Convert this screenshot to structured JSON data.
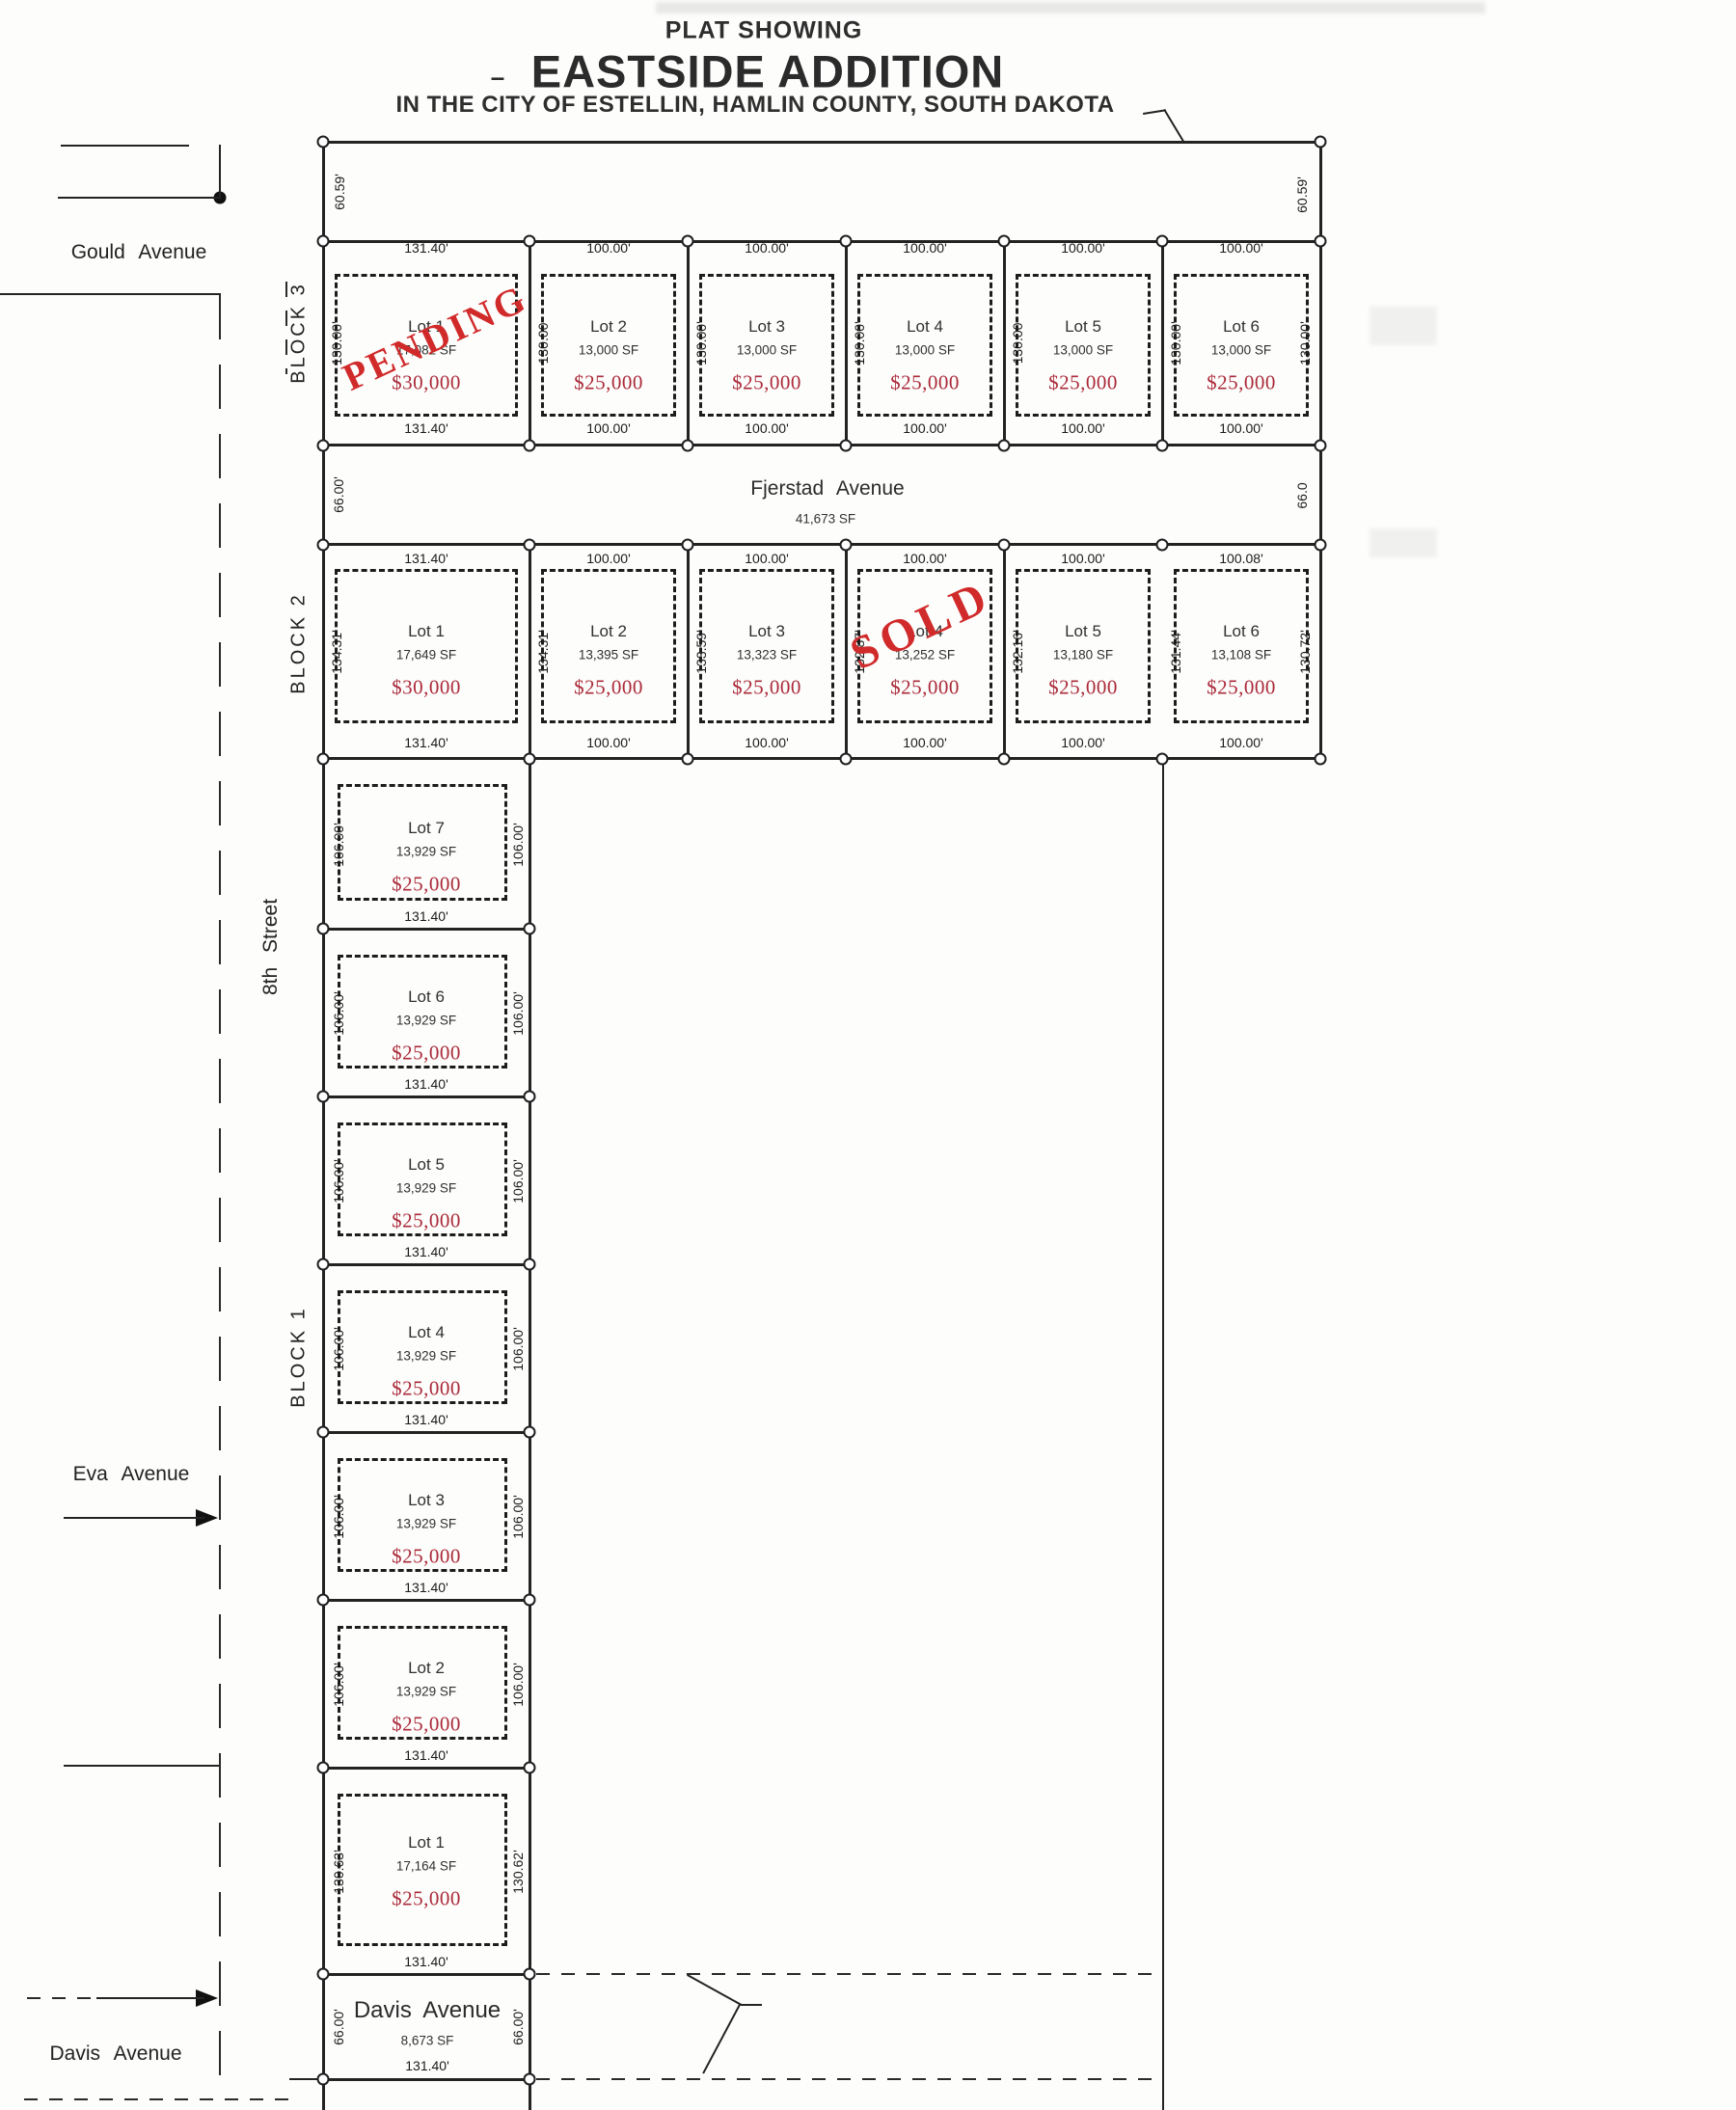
{
  "title": {
    "kicker": "PLAT SHOWING",
    "dash": "–",
    "name": "EASTSIDE ADDITION",
    "subtitle": "IN THE CITY OF ESTELLIN, HAMLIN COUNTY, SOUTH DAKOTA"
  },
  "streets": {
    "gould": "Gould Avenue",
    "eighth": "8th Street",
    "eva": "Eva Avenue",
    "davis": "Davis Avenue"
  },
  "avenue_fjerstad": {
    "name": "Fjerstad Avenue",
    "sf": "41,673 SF",
    "dim_left": "66.00'",
    "dim_right": "66.0"
  },
  "avenue_davis": {
    "name": "Davis Avenue",
    "sf": "8,673 SF",
    "dim_bottom": "131.40'",
    "dim_left": "66.00'",
    "dim_right": "66.00'"
  },
  "boundary_dims": {
    "northwest": "60.59'",
    "northeast": "60.59'"
  },
  "stamps": {
    "pending": "PENDING",
    "sold": "SOLD"
  },
  "colors": {
    "price_red": "#ab2b3a",
    "stamp_red": "#d12a2a",
    "line": "#232323"
  },
  "blocks": {
    "block3": {
      "label": "BLOCK 3",
      "lots": [
        {
          "name": "Lot 1",
          "sf": "17,082 SF",
          "price": "$30,000",
          "status": "PENDING",
          "dim_top": "131.40'",
          "dim_bottom": "131.40'",
          "dim_left": "130.00'"
        },
        {
          "name": "Lot 2",
          "sf": "13,000 SF",
          "price": "$25,000",
          "dim_top": "100.00'",
          "dim_bottom": "100.00'",
          "dim_left": "130.00"
        },
        {
          "name": "Lot 3",
          "sf": "13,000 SF",
          "price": "$25,000",
          "dim_top": "100.00'",
          "dim_bottom": "100.00'",
          "dim_left": "130.00'"
        },
        {
          "name": "Lot 4",
          "sf": "13,000 SF",
          "price": "$25,000",
          "dim_top": "100.00'",
          "dim_bottom": "100.00'",
          "dim_left": "130.00'"
        },
        {
          "name": "Lot 5",
          "sf": "13,000 SF",
          "price": "$25,000",
          "dim_top": "100.00'",
          "dim_bottom": "100.00'",
          "dim_left": "130.00"
        },
        {
          "name": "Lot 6",
          "sf": "13,000 SF",
          "price": "$25,000",
          "dim_top": "100.00'",
          "dim_bottom": "100.00'",
          "dim_left": "130.00'",
          "dim_right": "130.00'"
        }
      ]
    },
    "block2": {
      "label": "BLOCK 2",
      "lots": [
        {
          "name": "Lot 1",
          "sf": "17,649 SF",
          "price": "$30,000",
          "dim_top": "131.40'",
          "dim_bottom": "131.40'",
          "dim_left": "134.31'"
        },
        {
          "name": "Lot 2",
          "sf": "13,395 SF",
          "price": "$25,000",
          "dim_top": "100.00'",
          "dim_bottom": "100.00'",
          "dim_left": "134.31'"
        },
        {
          "name": "Lot 3",
          "sf": "13,323 SF",
          "price": "$25,000",
          "dim_top": "100.00'",
          "dim_bottom": "100.00'",
          "dim_left": "133.59'"
        },
        {
          "name": "Lot 4",
          "sf": "13,252 SF",
          "price": "$25,000",
          "status": "SOLD",
          "dim_top": "100.00'",
          "dim_bottom": "100.00'",
          "dim_left": "132.87'"
        },
        {
          "name": "Lot 5",
          "sf": "13,180 SF",
          "price": "$25,000",
          "dim_top": "100.00'",
          "dim_bottom": "100.00'",
          "dim_left": "132.16'"
        },
        {
          "name": "Lot 6",
          "sf": "13,108 SF",
          "price": "$25,000",
          "dim_top": "100.08'",
          "dim_bottom": "100.00'",
          "dim_left": "131.44'",
          "dim_right": "130.72'"
        }
      ]
    },
    "block1": {
      "label": "BLOCK 1",
      "lots": [
        {
          "name": "Lot 7",
          "sf": "13,929 SF",
          "price": "$25,000",
          "dim_bottom": "131.40'",
          "dim_left": "106.00'",
          "dim_right": "106.00'"
        },
        {
          "name": "Lot 6",
          "sf": "13,929 SF",
          "price": "$25,000",
          "dim_bottom": "131.40'",
          "dim_left": "106.00'",
          "dim_right": "106.00'"
        },
        {
          "name": "Lot 5",
          "sf": "13,929 SF",
          "price": "$25,000",
          "dim_bottom": "131.40'",
          "dim_left": "106.00'",
          "dim_right": "106.00'"
        },
        {
          "name": "Lot 4",
          "sf": "13,929 SF",
          "price": "$25,000",
          "dim_bottom": "131.40'",
          "dim_left": "106.00'",
          "dim_right": "106.00'"
        },
        {
          "name": "Lot 3",
          "sf": "13,929 SF",
          "price": "$25,000",
          "dim_bottom": "131.40'",
          "dim_left": "106.00'",
          "dim_right": "106.00'"
        },
        {
          "name": "Lot 2",
          "sf": "13,929 SF",
          "price": "$25,000",
          "dim_bottom": "131.40'",
          "dim_left": "106.00'",
          "dim_right": "106.00'"
        },
        {
          "name": "Lot 1",
          "sf": "17,164 SF",
          "price": "$25,000",
          "dim_bottom": "131.40'",
          "dim_left": "130.63'",
          "dim_right": "130.62'"
        }
      ]
    }
  }
}
